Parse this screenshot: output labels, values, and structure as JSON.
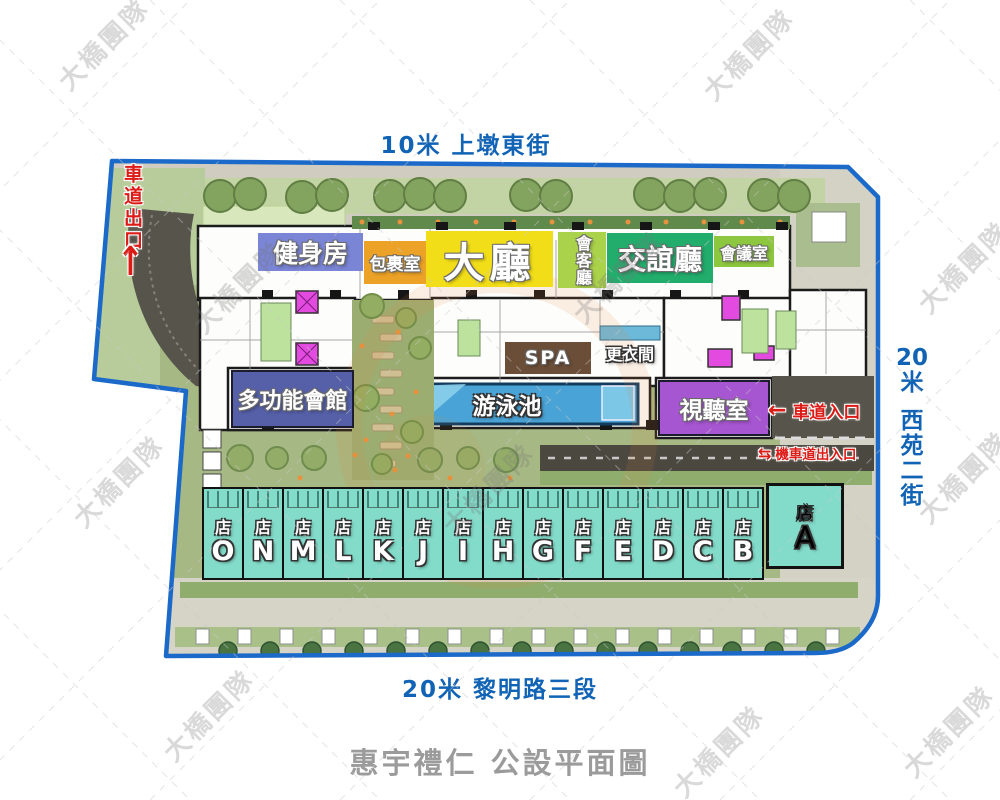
{
  "watermark": {
    "text": "大橋團隊"
  },
  "streets": {
    "top": {
      "label": "10米 上墩東街",
      "color": "#1063b5"
    },
    "bottom": {
      "label": "20米 黎明路三段",
      "color": "#1063b5"
    },
    "right": {
      "width_label": "20米",
      "name": "西苑二街",
      "color": "#1063b5"
    }
  },
  "title": {
    "label": "惠宇禮仁 公設平面圖",
    "color": "#9b9b9b"
  },
  "access": {
    "exit": {
      "label": "車道出口",
      "arrow": "↑",
      "color": "#dc1a16"
    },
    "car_entrance": {
      "label": "車道入口",
      "arrow": "←",
      "color": "#dc1a16"
    },
    "moto": {
      "label": "機車道出入口",
      "arrow": "⇆",
      "color": "#dc1a16"
    }
  },
  "facilities": {
    "gym": {
      "label": "健身房",
      "color": "#7b85d6"
    },
    "package": {
      "label": "包裹室",
      "color": "#eca226"
    },
    "lobby": {
      "label": "大廳",
      "color": "#f2de18"
    },
    "reception": {
      "label": "會客廳",
      "color": "#abd24b"
    },
    "social": {
      "label": "交誼廳",
      "color": "#22ad6c"
    },
    "meeting": {
      "label": "會議室",
      "color": "#8dc63f"
    },
    "spa": {
      "label": "SPA",
      "color": "#6b4e38"
    },
    "changing": {
      "label": "更衣間",
      "color": "transparent"
    },
    "multi": {
      "label": "多功能會館",
      "color": "#5560a8"
    },
    "pool": {
      "label": "游泳池",
      "color": "#4aa3d6"
    },
    "av": {
      "label": "視聽室",
      "color": "#a656d0"
    }
  },
  "shops": {
    "prefix": "店",
    "color": "#83dcca",
    "narrow_letters": [
      "O",
      "N",
      "M",
      "L",
      "K",
      "J",
      "I",
      "H",
      "G",
      "F",
      "E",
      "D",
      "C",
      "B"
    ],
    "wide_letter": "A"
  }
}
